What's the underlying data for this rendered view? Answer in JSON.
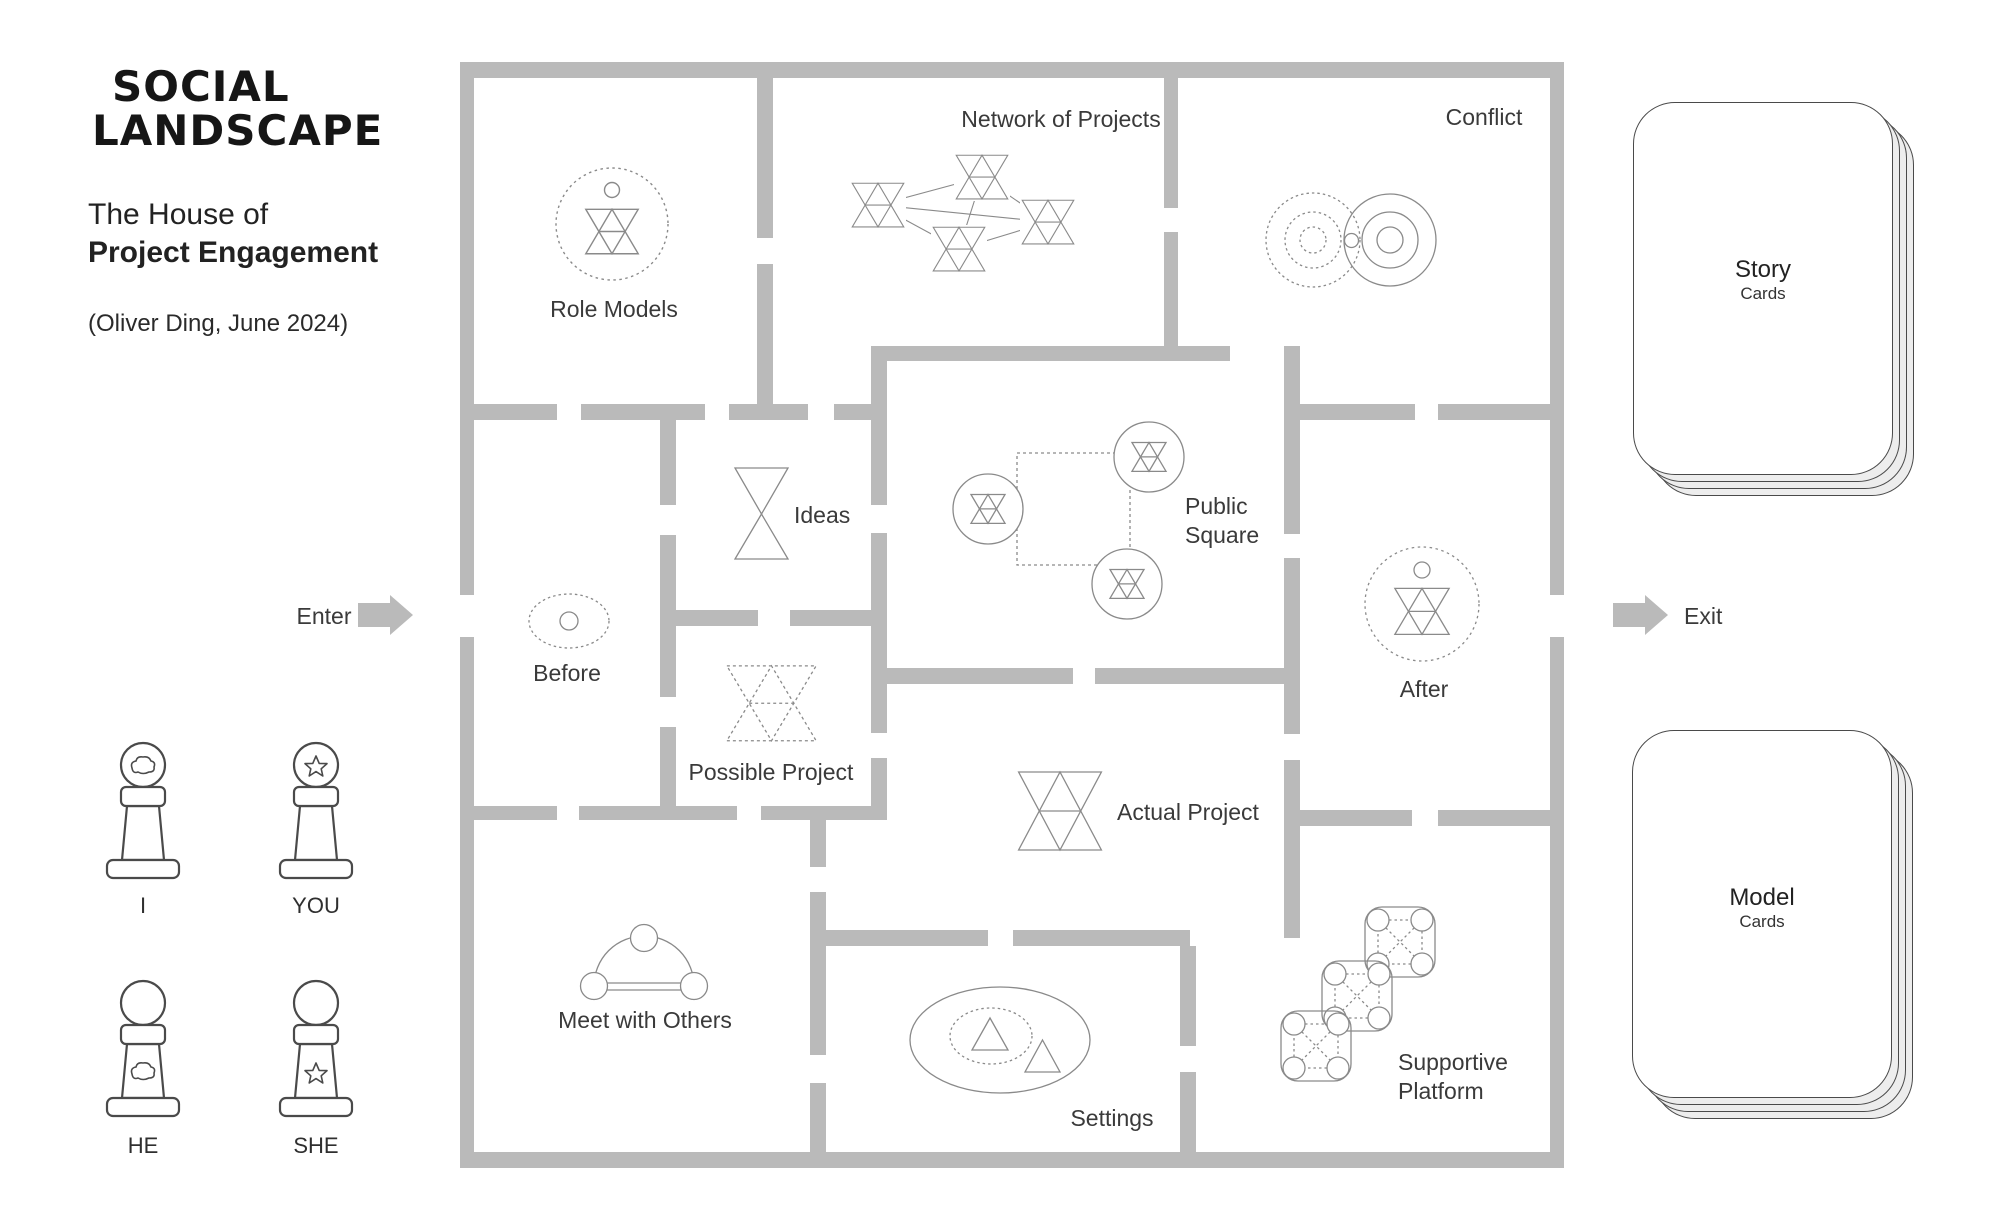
{
  "branding": {
    "logo_line1": "SOCIAL",
    "logo_line2": "LANDSCAPE"
  },
  "title": {
    "line1": "The House of",
    "line2": "Project Engagement",
    "byline": "(Oliver Ding, June 2024)"
  },
  "rooms": {
    "role_models": {
      "label": "Role Models",
      "icon": "dotted-circle-project-model"
    },
    "network_of_projects": {
      "label": "Network of Projects",
      "icon": "linked-project-glyphs-network"
    },
    "conflict": {
      "label": "Conflict",
      "icon": "two-overlapping-ring-sets"
    },
    "ideas": {
      "label": "Ideas",
      "icon": "hourglass-triangles"
    },
    "public_square": {
      "line1": "Public",
      "line2": "Square",
      "icon": "three-circled-glyphs-on-dotted-square"
    },
    "before": {
      "label": "Before",
      "icon": "dotted-ellipse-with-circle"
    },
    "possible_project": {
      "label": "Possible Project",
      "icon": "dotted-project-model"
    },
    "actual_project": {
      "label": "Actual Project",
      "icon": "project-model"
    },
    "after": {
      "label": "After",
      "icon": "dotted-circle-project-model"
    },
    "meet_with_others": {
      "label": "Meet with Others",
      "icon": "arc-with-three-nodes"
    },
    "settings": {
      "label": "Settings",
      "icon": "ellipse-with-triangles"
    },
    "supportive_platform": {
      "line1": "Supportive",
      "line2": "Platform",
      "icon": "chained-platform-tables"
    }
  },
  "markers": {
    "enter": "Enter",
    "exit": "Exit"
  },
  "pawns": [
    {
      "label": "I",
      "symbol": "cloud",
      "symbol_on": "head"
    },
    {
      "label": "YOU",
      "symbol": "star",
      "symbol_on": "head"
    },
    {
      "label": "HE",
      "symbol": "cloud",
      "symbol_on": "body"
    },
    {
      "label": "SHE",
      "symbol": "star",
      "symbol_on": "body"
    }
  ],
  "decks": [
    {
      "title": "Story",
      "subtitle": "Cards"
    },
    {
      "title": "Model",
      "subtitle": "Cards"
    }
  ],
  "colors": {
    "wall": "#bababa",
    "icon_stroke": "#8a8a8a",
    "figure_stroke": "#4a4a4a",
    "text": "#3a3a3a",
    "card_back": "#ededed"
  }
}
